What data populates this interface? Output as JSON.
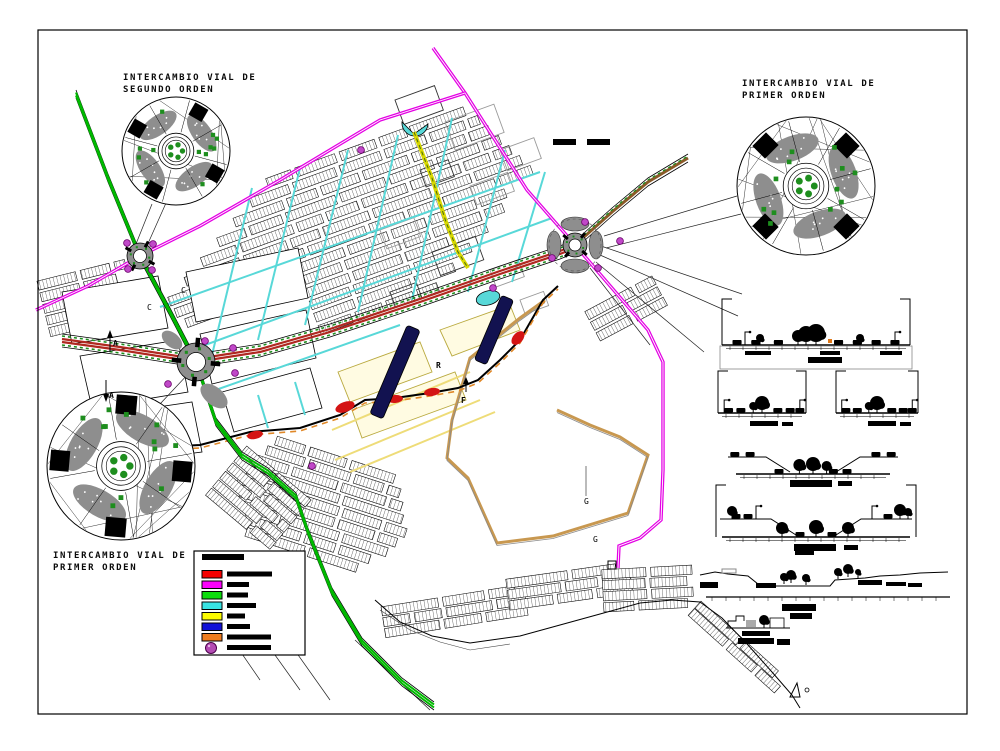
{
  "callouts": {
    "second_order": {
      "line1": "INTERCAMBIO VIAL DE",
      "line2": "SEGUNDO ORDEN"
    },
    "first_order_right": {
      "line1": "INTERCAMBIO VIAL DE",
      "line2": "PRIMER ORDEN"
    },
    "first_order_left": {
      "line1": "INTERCAMBIO VIAL DE",
      "line2": "PRIMER ORDEN"
    }
  },
  "scale_bar": {
    "segments": 2
  },
  "letters": {
    "section_top": "A",
    "section_bottom": "A",
    "sheet_number": "1",
    "c_upper": "C",
    "c_lower": "C",
    "f_marker": "F",
    "r_marker": "R",
    "g_upper": "G",
    "g_lower": "G"
  },
  "legend": {
    "title_redacted_bar_width": 42,
    "items": [
      {
        "id": "route-red",
        "shape": "swatch",
        "color": "#f40000",
        "bar_w": 45
      },
      {
        "id": "route-magenta",
        "shape": "swatch",
        "color": "#fb00fb",
        "bar_w": 22
      },
      {
        "id": "route-green",
        "shape": "swatch",
        "color": "#0cdc0c",
        "bar_w": 21
      },
      {
        "id": "route-cyan",
        "shape": "swatch",
        "color": "#37e3e3",
        "bar_w": 29
      },
      {
        "id": "route-yellow",
        "shape": "swatch",
        "color": "#fcfc00",
        "bar_w": 18
      },
      {
        "id": "route-blue",
        "shape": "swatch",
        "color": "#1111d8",
        "bar_w": 23
      },
      {
        "id": "route-orange",
        "shape": "swatch",
        "color": "#ef7d1f",
        "bar_w": 44
      },
      {
        "id": "node-purple",
        "shape": "circle",
        "color": "#b44cb4",
        "bar_w": 44
      }
    ]
  },
  "colors": {
    "frame": "#000000",
    "green_road": "#00b800",
    "magenta_road": "#e400e4",
    "avenue_red": "#b02820",
    "brown_road": "#8a5a28",
    "cyan_street": "#58d8d8",
    "yellow_road": "#d8d800",
    "pale_street": "#eedc78",
    "tan_boundary": "#c89850",
    "orange_dash": "#e08828",
    "underpass_blue": "#121250",
    "red_blob": "#d41414",
    "purple_dot": "#c048c8",
    "gray_fill": "#8e8e8e",
    "tree_green": "#1e8e1e",
    "section_orange": "#e07818"
  }
}
